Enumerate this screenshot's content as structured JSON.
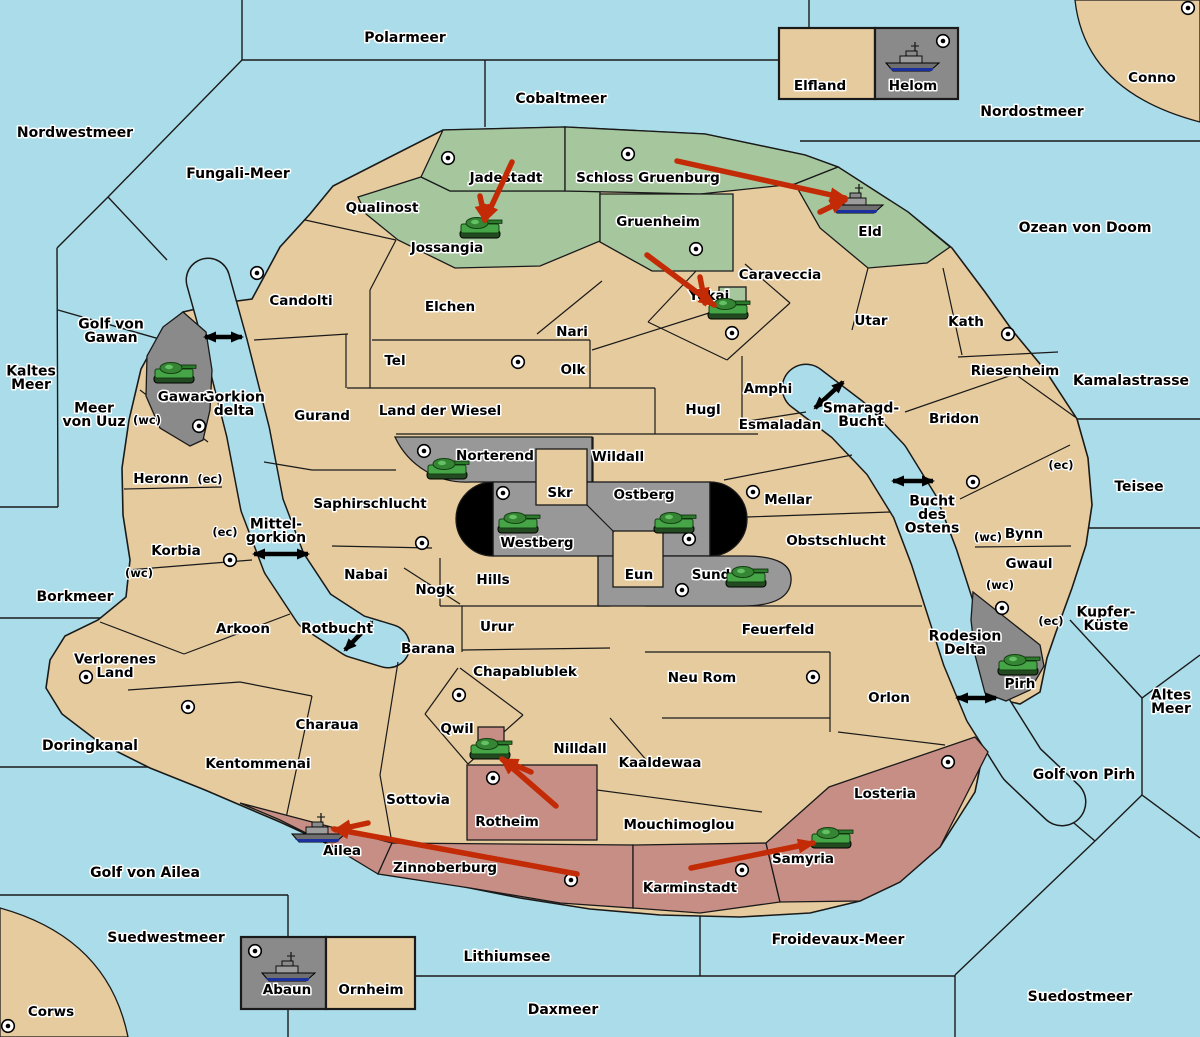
{
  "canvas": {
    "width": 1200,
    "height": 1037
  },
  "colors": {
    "sea": "#aadde9",
    "land": "#e6cb9e",
    "green": "#a6c79e",
    "pink": "#c78e85",
    "gray": "#989898",
    "darkgray": "#8a8a8a",
    "border": "#1a1a1a",
    "impassable": "#000000",
    "arrow_red": "#c32b06",
    "label": "#000000",
    "halo": "#ffffff"
  },
  "sea_labels": [
    {
      "name": "Polarmeer",
      "lines": [
        "Polarmeer"
      ],
      "x": 405,
      "y": 38
    },
    {
      "name": "Cobaltmeer",
      "lines": [
        "Cobaltmeer"
      ],
      "x": 561,
      "y": 99
    },
    {
      "name": "Nordwestmeer",
      "lines": [
        "Nordwestmeer"
      ],
      "x": 75,
      "y": 133
    },
    {
      "name": "Fungali-Meer",
      "lines": [
        "Fungali-Meer"
      ],
      "x": 238,
      "y": 174
    },
    {
      "name": "Nordostmeer",
      "lines": [
        "Nordostmeer"
      ],
      "x": 1032,
      "y": 112
    },
    {
      "name": "Ozean von Doom",
      "lines": [
        "Ozean von Doom"
      ],
      "x": 1085,
      "y": 228
    },
    {
      "name": "Kaltes Meer",
      "lines": [
        "Kaltes",
        "Meer"
      ],
      "x": 31,
      "y": 378
    },
    {
      "name": "Golf von Gawan",
      "lines": [
        "Golf von",
        "Gawan"
      ],
      "x": 111,
      "y": 331
    },
    {
      "name": "Meer von Uuz",
      "lines": [
        "Meer",
        "von Uuz"
      ],
      "x": 94,
      "y": 415
    },
    {
      "name": "Borkmeer",
      "lines": [
        "Borkmeer"
      ],
      "x": 75,
      "y": 597
    },
    {
      "name": "Doringkanal",
      "lines": [
        "Doringkanal"
      ],
      "x": 90,
      "y": 746
    },
    {
      "name": "Golf von Ailea",
      "lines": [
        "Golf von Ailea"
      ],
      "x": 145,
      "y": 873
    },
    {
      "name": "Suedwestmeer",
      "lines": [
        "Suedwestmeer"
      ],
      "x": 166,
      "y": 938
    },
    {
      "name": "Lithiumsee",
      "lines": [
        "Lithiumsee"
      ],
      "x": 507,
      "y": 957
    },
    {
      "name": "Daxmeer",
      "lines": [
        "Daxmeer"
      ],
      "x": 563,
      "y": 1010
    },
    {
      "name": "Suedostmeer",
      "lines": [
        "Suedostmeer"
      ],
      "x": 1080,
      "y": 997
    },
    {
      "name": "Froidevaux-Meer",
      "lines": [
        "Froidevaux-Meer"
      ],
      "x": 838,
      "y": 940
    },
    {
      "name": "Golf von Pirh",
      "lines": [
        "Golf von Pirh"
      ],
      "x": 1084,
      "y": 775
    },
    {
      "name": "Altes Meer",
      "lines": [
        "Altes",
        "Meer"
      ],
      "x": 1171,
      "y": 702
    },
    {
      "name": "Kupfer-Kueste",
      "lines": [
        "Kupfer-",
        "Küste"
      ],
      "x": 1106,
      "y": 619
    },
    {
      "name": "Teisee",
      "lines": [
        "Teisee"
      ],
      "x": 1139,
      "y": 487
    },
    {
      "name": "Kamalastrasse",
      "lines": [
        "Kamalastrasse"
      ],
      "x": 1131,
      "y": 381
    },
    {
      "name": "Gorkion delta",
      "lines": [
        "Gorkion",
        "delta"
      ],
      "x": 234,
      "y": 404
    },
    {
      "name": "Mittel-gorkion",
      "lines": [
        "Mittel-",
        "gorkion"
      ],
      "x": 276,
      "y": 531
    },
    {
      "name": "Rotbucht",
      "lines": [
        "Rotbucht"
      ],
      "x": 337,
      "y": 629
    },
    {
      "name": "Smaragd-Bucht",
      "lines": [
        "Smaragd-",
        "Bucht"
      ],
      "x": 861,
      "y": 415
    },
    {
      "name": "Bucht des Ostens",
      "lines": [
        "Bucht",
        "des",
        "Ostens"
      ],
      "x": 932,
      "y": 515
    },
    {
      "name": "Rodesion Delta",
      "lines": [
        "Rodesion",
        "Delta"
      ],
      "x": 965,
      "y": 643
    }
  ],
  "land_labels": [
    {
      "name": "Qualinost",
      "lines": [
        "Qualinost"
      ],
      "x": 382,
      "y": 208
    },
    {
      "name": "Candolti",
      "lines": [
        "Candolti"
      ],
      "x": 301,
      "y": 301
    },
    {
      "name": "Gurand",
      "lines": [
        "Gurand"
      ],
      "x": 322,
      "y": 416
    },
    {
      "name": "Elchen",
      "lines": [
        "Elchen"
      ],
      "x": 450,
      "y": 307
    },
    {
      "name": "Nari",
      "lines": [
        "Nari"
      ],
      "x": 572,
      "y": 332
    },
    {
      "name": "Tel",
      "lines": [
        "Tel"
      ],
      "x": 395,
      "y": 361
    },
    {
      "name": "Olk",
      "lines": [
        "Olk"
      ],
      "x": 573,
      "y": 370
    },
    {
      "name": "Land der Wiesel",
      "lines": [
        "Land der Wiesel"
      ],
      "x": 440,
      "y": 411
    },
    {
      "name": "Hugl",
      "lines": [
        "Hugl"
      ],
      "x": 703,
      "y": 410
    },
    {
      "name": "Amphi",
      "lines": [
        "Amphi"
      ],
      "x": 768,
      "y": 389
    },
    {
      "name": "Esmaladan",
      "lines": [
        "Esmaladan"
      ],
      "x": 780,
      "y": 425
    },
    {
      "name": "Caraveccia",
      "lines": [
        "Caraveccia"
      ],
      "x": 780,
      "y": 275
    },
    {
      "name": "Utar",
      "lines": [
        "Utar"
      ],
      "x": 871,
      "y": 321
    },
    {
      "name": "Kath",
      "lines": [
        "Kath"
      ],
      "x": 966,
      "y": 322
    },
    {
      "name": "Riesenheim",
      "lines": [
        "Riesenheim"
      ],
      "x": 1015,
      "y": 371
    },
    {
      "name": "Bridon",
      "lines": [
        "Bridon"
      ],
      "x": 954,
      "y": 419
    },
    {
      "name": "Bynn",
      "lines": [
        "Bynn"
      ],
      "x": 1024,
      "y": 534
    },
    {
      "name": "Gwaul",
      "lines": [
        "Gwaul"
      ],
      "x": 1029,
      "y": 564
    },
    {
      "name": "Mellar",
      "lines": [
        "Mellar"
      ],
      "x": 788,
      "y": 500
    },
    {
      "name": "Obstschlucht",
      "lines": [
        "Obstschlucht"
      ],
      "x": 836,
      "y": 541
    },
    {
      "name": "Wildall",
      "lines": [
        "Wildall"
      ],
      "x": 618,
      "y": 457
    },
    {
      "name": "Skr",
      "lines": [
        "Skr"
      ],
      "x": 560,
      "y": 493
    },
    {
      "name": "Eun",
      "lines": [
        "Eun"
      ],
      "x": 639,
      "y": 575
    },
    {
      "name": "Hills",
      "lines": [
        "Hills"
      ],
      "x": 493,
      "y": 580
    },
    {
      "name": "Saphirschlucht",
      "lines": [
        "Saphirschlucht"
      ],
      "x": 370,
      "y": 504
    },
    {
      "name": "Nabai",
      "lines": [
        "Nabai"
      ],
      "x": 366,
      "y": 575
    },
    {
      "name": "Nogk",
      "lines": [
        "Nogk"
      ],
      "x": 435,
      "y": 590
    },
    {
      "name": "Urur",
      "lines": [
        "Urur"
      ],
      "x": 497,
      "y": 627
    },
    {
      "name": "Barana",
      "lines": [
        "Barana"
      ],
      "x": 428,
      "y": 649
    },
    {
      "name": "Chapablublek",
      "lines": [
        "Chapablublek"
      ],
      "x": 525,
      "y": 672
    },
    {
      "name": "Qwil",
      "lines": [
        "Qwil"
      ],
      "x": 457,
      "y": 729
    },
    {
      "name": "Nilldall",
      "lines": [
        "Nilldall"
      ],
      "x": 580,
      "y": 749
    },
    {
      "name": "Neu Rom",
      "lines": [
        "Neu Rom"
      ],
      "x": 702,
      "y": 678
    },
    {
      "name": "Feuerfeld",
      "lines": [
        "Feuerfeld"
      ],
      "x": 778,
      "y": 630
    },
    {
      "name": "Orlon",
      "lines": [
        "Orlon"
      ],
      "x": 889,
      "y": 698
    },
    {
      "name": "Losteria",
      "lines": [
        "Losteria"
      ],
      "x": 885,
      "y": 794
    },
    {
      "name": "Kaaldewaa",
      "lines": [
        "Kaaldewaa"
      ],
      "x": 660,
      "y": 763
    },
    {
      "name": "Mouchimoglou",
      "lines": [
        "Mouchimoglou"
      ],
      "x": 679,
      "y": 825
    },
    {
      "name": "Sottovia",
      "lines": [
        "Sottovia"
      ],
      "x": 418,
      "y": 800
    },
    {
      "name": "Heronn",
      "lines": [
        "Heronn"
      ],
      "x": 161,
      "y": 479
    },
    {
      "name": "Korbia",
      "lines": [
        "Korbia"
      ],
      "x": 176,
      "y": 551
    },
    {
      "name": "Arkoon",
      "lines": [
        "Arkoon"
      ],
      "x": 243,
      "y": 629
    },
    {
      "name": "Verlorenes Land",
      "lines": [
        "Verlorenes",
        "Land"
      ],
      "x": 115,
      "y": 666
    },
    {
      "name": "Kentommenai",
      "lines": [
        "Kentommenai"
      ],
      "x": 258,
      "y": 764
    },
    {
      "name": "Charaua",
      "lines": [
        "Charaua"
      ],
      "x": 327,
      "y": 725
    },
    {
      "name": "Rotheim",
      "lines": [
        "Rotheim"
      ],
      "x": 507,
      "y": 822
    },
    {
      "name": "Ailea",
      "lines": [
        "Ailea"
      ],
      "x": 342,
      "y": 851
    },
    {
      "name": "Zinnoberburg",
      "lines": [
        "Zinnoberburg"
      ],
      "x": 445,
      "y": 868
    },
    {
      "name": "Karminstadt",
      "lines": [
        "Karminstadt"
      ],
      "x": 690,
      "y": 888
    },
    {
      "name": "Samyria",
      "lines": [
        "Samyria"
      ],
      "x": 803,
      "y": 859
    },
    {
      "name": "Jadestadt",
      "lines": [
        "Jadestadt"
      ],
      "x": 506,
      "y": 178
    },
    {
      "name": "Jossangia",
      "lines": [
        "Jossangia"
      ],
      "x": 447,
      "y": 248
    },
    {
      "name": "Schloss Gruenburg",
      "lines": [
        "Schloss Gruenburg"
      ],
      "x": 648,
      "y": 178
    },
    {
      "name": "Gruenheim",
      "lines": [
        "Gruenheim"
      ],
      "x": 658,
      "y": 222
    },
    {
      "name": "Eld",
      "lines": [
        "Eld"
      ],
      "x": 870,
      "y": 232
    },
    {
      "name": "Yokai",
      "lines": [
        "Yokai"
      ],
      "x": 709,
      "y": 296
    },
    {
      "name": "Gawar",
      "lines": [
        "Gawar"
      ],
      "x": 182,
      "y": 397
    },
    {
      "name": "Norterend",
      "lines": [
        "Norterend"
      ],
      "x": 495,
      "y": 456
    },
    {
      "name": "Westberg",
      "lines": [
        "Westberg"
      ],
      "x": 537,
      "y": 543
    },
    {
      "name": "Ostberg",
      "lines": [
        "Ostberg"
      ],
      "x": 644,
      "y": 495
    },
    {
      "name": "Sund",
      "lines": [
        "Sund"
      ],
      "x": 711,
      "y": 575
    },
    {
      "name": "Pirh",
      "lines": [
        "Pirh"
      ],
      "x": 1020,
      "y": 684
    },
    {
      "name": "Elfland",
      "lines": [
        "Elfland"
      ],
      "x": 820,
      "y": 86
    },
    {
      "name": "Helom",
      "lines": [
        "Helom"
      ],
      "x": 913,
      "y": 86
    },
    {
      "name": "Abaun",
      "lines": [
        "Abaun"
      ],
      "x": 287,
      "y": 990
    },
    {
      "name": "Ornheim",
      "lines": [
        "Ornheim"
      ],
      "x": 371,
      "y": 990
    },
    {
      "name": "Conno",
      "lines": [
        "Conno"
      ],
      "x": 1152,
      "y": 78
    },
    {
      "name": "Corws",
      "lines": [
        "Corws"
      ],
      "x": 51,
      "y": 1012
    }
  ],
  "coast_markers": [
    {
      "text": "(wc)",
      "x": 147,
      "y": 420
    },
    {
      "text": "(ec)",
      "x": 210,
      "y": 479
    },
    {
      "text": "(ec)",
      "x": 225,
      "y": 532
    },
    {
      "text": "(wc)",
      "x": 139,
      "y": 573
    },
    {
      "text": "(ec)",
      "x": 1061,
      "y": 465
    },
    {
      "text": "(wc)",
      "x": 988,
      "y": 537
    },
    {
      "text": "(wc)",
      "x": 1000,
      "y": 585
    },
    {
      "text": "(ec)",
      "x": 1051,
      "y": 621
    }
  ],
  "supply_centers": [
    {
      "region": "Jadestadt",
      "x": 448,
      "y": 158
    },
    {
      "region": "Schloss Gruenburg",
      "x": 628,
      "y": 154
    },
    {
      "region": "Gruenheim",
      "x": 696,
      "y": 249
    },
    {
      "region": "Helom",
      "x": 943,
      "y": 41
    },
    {
      "region": "Conno",
      "x": 1188,
      "y": 8
    },
    {
      "region": "Candolti",
      "x": 257,
      "y": 273
    },
    {
      "region": "Tel",
      "x": 518,
      "y": 362
    },
    {
      "region": "Yokai",
      "x": 732,
      "y": 333
    },
    {
      "region": "Kath",
      "x": 1008,
      "y": 334
    },
    {
      "region": "Gawar",
      "x": 199,
      "y": 426
    },
    {
      "region": "Bridon",
      "x": 973,
      "y": 482
    },
    {
      "region": "Mellar",
      "x": 753,
      "y": 492
    },
    {
      "region": "Norterend",
      "x": 424,
      "y": 451
    },
    {
      "region": "Westberg",
      "x": 503,
      "y": 493
    },
    {
      "region": "Ostberg",
      "x": 689,
      "y": 539
    },
    {
      "region": "Sund",
      "x": 682,
      "y": 590
    },
    {
      "region": "Saphirschlucht",
      "x": 422,
      "y": 543
    },
    {
      "region": "Korbia",
      "x": 230,
      "y": 560
    },
    {
      "region": "Verlorenes Land",
      "x": 86,
      "y": 677
    },
    {
      "region": "Kentommenai",
      "x": 188,
      "y": 707
    },
    {
      "region": "Neu Rom",
      "x": 813,
      "y": 677
    },
    {
      "region": "Qwil",
      "x": 459,
      "y": 695
    },
    {
      "region": "Rotheim",
      "x": 493,
      "y": 778
    },
    {
      "region": "Zinnoberburg",
      "x": 571,
      "y": 880
    },
    {
      "region": "Karminstadt",
      "x": 742,
      "y": 870
    },
    {
      "region": "Losteria",
      "x": 948,
      "y": 762
    },
    {
      "region": "Pirh",
      "x": 1002,
      "y": 608
    },
    {
      "region": "Abaun",
      "x": 255,
      "y": 951
    },
    {
      "region": "Corws",
      "x": 8,
      "y": 1026
    }
  ],
  "units": [
    {
      "type": "tank",
      "region": "Jossangia",
      "x": 480,
      "y": 229
    },
    {
      "type": "tank",
      "region": "Yokai",
      "x": 728,
      "y": 310
    },
    {
      "type": "tank",
      "region": "Gawar",
      "x": 174,
      "y": 374
    },
    {
      "type": "tank",
      "region": "Norterend",
      "x": 447,
      "y": 470
    },
    {
      "type": "tank",
      "region": "Westberg",
      "x": 518,
      "y": 524
    },
    {
      "type": "tank",
      "region": "Ostberg",
      "x": 674,
      "y": 524
    },
    {
      "type": "tank",
      "region": "Sund",
      "x": 746,
      "y": 578
    },
    {
      "type": "tank",
      "region": "Qwil",
      "x": 490,
      "y": 750
    },
    {
      "type": "tank",
      "region": "Samyria",
      "x": 831,
      "y": 839
    },
    {
      "type": "tank",
      "region": "Pirh",
      "x": 1018,
      "y": 666
    },
    {
      "type": "ship",
      "region": "Helom",
      "x": 912,
      "y": 60
    },
    {
      "type": "ship",
      "region": "Eld",
      "x": 856,
      "y": 202
    },
    {
      "type": "ship",
      "region": "Ailea",
      "x": 318,
      "y": 831
    },
    {
      "type": "ship",
      "region": "Abaun",
      "x": 288,
      "y": 970
    }
  ],
  "move_arrows": [
    {
      "x1": 512,
      "y1": 162,
      "x2": 485,
      "y2": 220
    },
    {
      "x1": 480,
      "y1": 196,
      "x2": 485,
      "y2": 220
    },
    {
      "x1": 677,
      "y1": 161,
      "x2": 845,
      "y2": 198
    },
    {
      "x1": 820,
      "y1": 212,
      "x2": 845,
      "y2": 200
    },
    {
      "x1": 647,
      "y1": 255,
      "x2": 714,
      "y2": 305
    },
    {
      "x1": 700,
      "y1": 277,
      "x2": 705,
      "y2": 303
    },
    {
      "x1": 556,
      "y1": 806,
      "x2": 502,
      "y2": 759
    },
    {
      "x1": 531,
      "y1": 772,
      "x2": 503,
      "y2": 760
    },
    {
      "x1": 577,
      "y1": 874,
      "x2": 334,
      "y2": 829
    },
    {
      "x1": 368,
      "y1": 823,
      "x2": 336,
      "y2": 830
    },
    {
      "x1": 691,
      "y1": 868,
      "x2": 813,
      "y2": 843
    }
  ],
  "passage_arrows": [
    {
      "x1": 205,
      "y1": 337,
      "x2": 242,
      "y2": 337
    },
    {
      "x1": 254,
      "y1": 554,
      "x2": 308,
      "y2": 554
    },
    {
      "x1": 345,
      "y1": 650,
      "x2": 372,
      "y2": 622
    },
    {
      "x1": 815,
      "y1": 408,
      "x2": 843,
      "y2": 382
    },
    {
      "x1": 893,
      "y1": 481,
      "x2": 933,
      "y2": 481
    },
    {
      "x1": 957,
      "y1": 698,
      "x2": 996,
      "y2": 698
    }
  ]
}
